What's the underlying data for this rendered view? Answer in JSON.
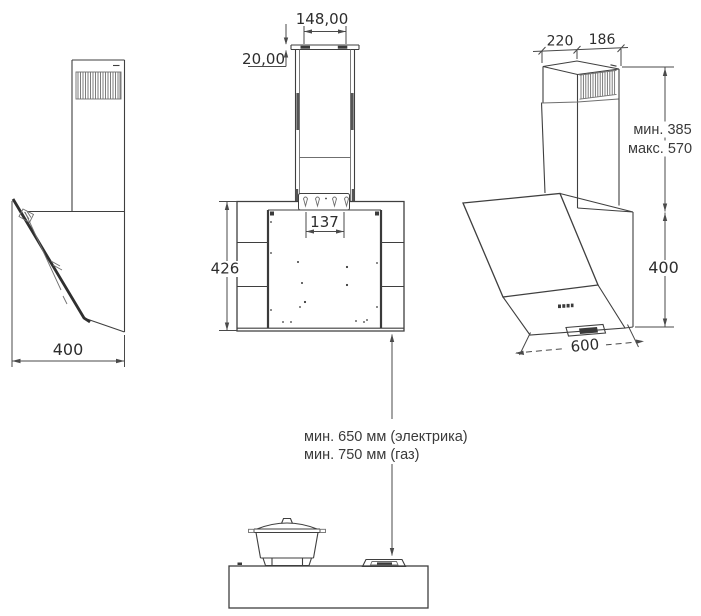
{
  "front_view": {
    "chimney_top_width": "148,00",
    "bracket_height": "20,00",
    "mounting_hole_spacing": "137",
    "body_height": "426"
  },
  "left_side_view": {
    "body_depth": "400"
  },
  "right_side_view": {
    "chimney_depth_front": "220",
    "chimney_depth_back": "186",
    "chimney_height_min": "мин. 385",
    "chimney_height_max": "макс. 570",
    "body_height": "400",
    "body_width": "600"
  },
  "installation": {
    "min_clearance_electric": "мин. 650 мм (электрика)",
    "min_clearance_gas": "мин. 750 мм (газ)"
  },
  "colors": {
    "line": "#3f3f3f",
    "dimension_line": "#4a4a4a",
    "text": "#2d2d2d",
    "dark_fill": "#3a3a3a",
    "background": "#ffffff"
  }
}
